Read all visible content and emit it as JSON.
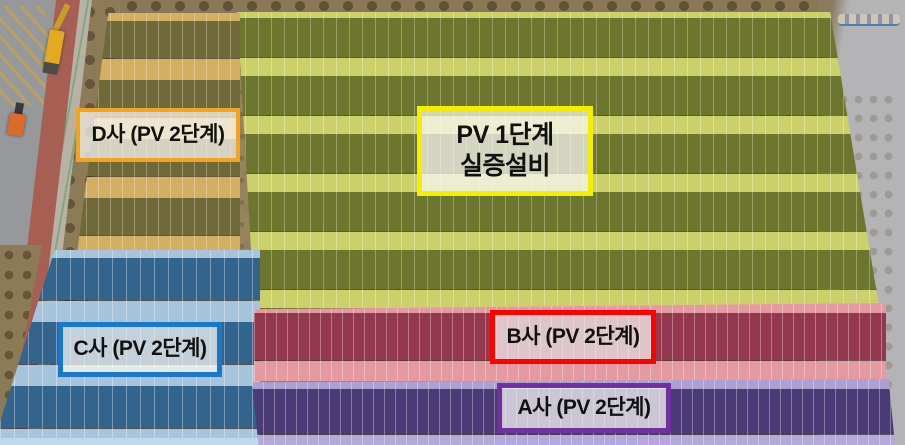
{
  "scene": {
    "description": "Aerial photo of solar PV demonstration site with annotated zones",
    "zones": {
      "pv1": {
        "label_line1": "PV 1단계",
        "label_line2": "실증설비",
        "border_color": "#f6ee00",
        "panel_tint": "#6d762f",
        "gap_tint": "#ccd06b"
      },
      "d": {
        "label": "D사 (PV 2단계)",
        "border_color": "#f2a41d",
        "panel_tint": "#6f6939",
        "gap_tint": "#d3ae63"
      },
      "c": {
        "label": "C사 (PV 2단계)",
        "border_color": "#1a78c8",
        "panel_tint": "#33648e",
        "gap_tint": "#a6c4dc"
      },
      "b": {
        "label": "B사 (PV 2단계)",
        "border_color": "#fe0000",
        "panel_tint": "#93384f",
        "gap_tint": "#e59aa2"
      },
      "a": {
        "label": "A사 (PV 2단계)",
        "border_color": "#7030a0",
        "panel_tint": "#4a3b76",
        "gap_tint": "#ab9fd3"
      }
    },
    "environment": {
      "vehicles": [
        "crane-truck",
        "forklift"
      ],
      "features": [
        "road",
        "bike-lane",
        "sidewalk",
        "tree-strip",
        "concrete-road"
      ]
    }
  }
}
